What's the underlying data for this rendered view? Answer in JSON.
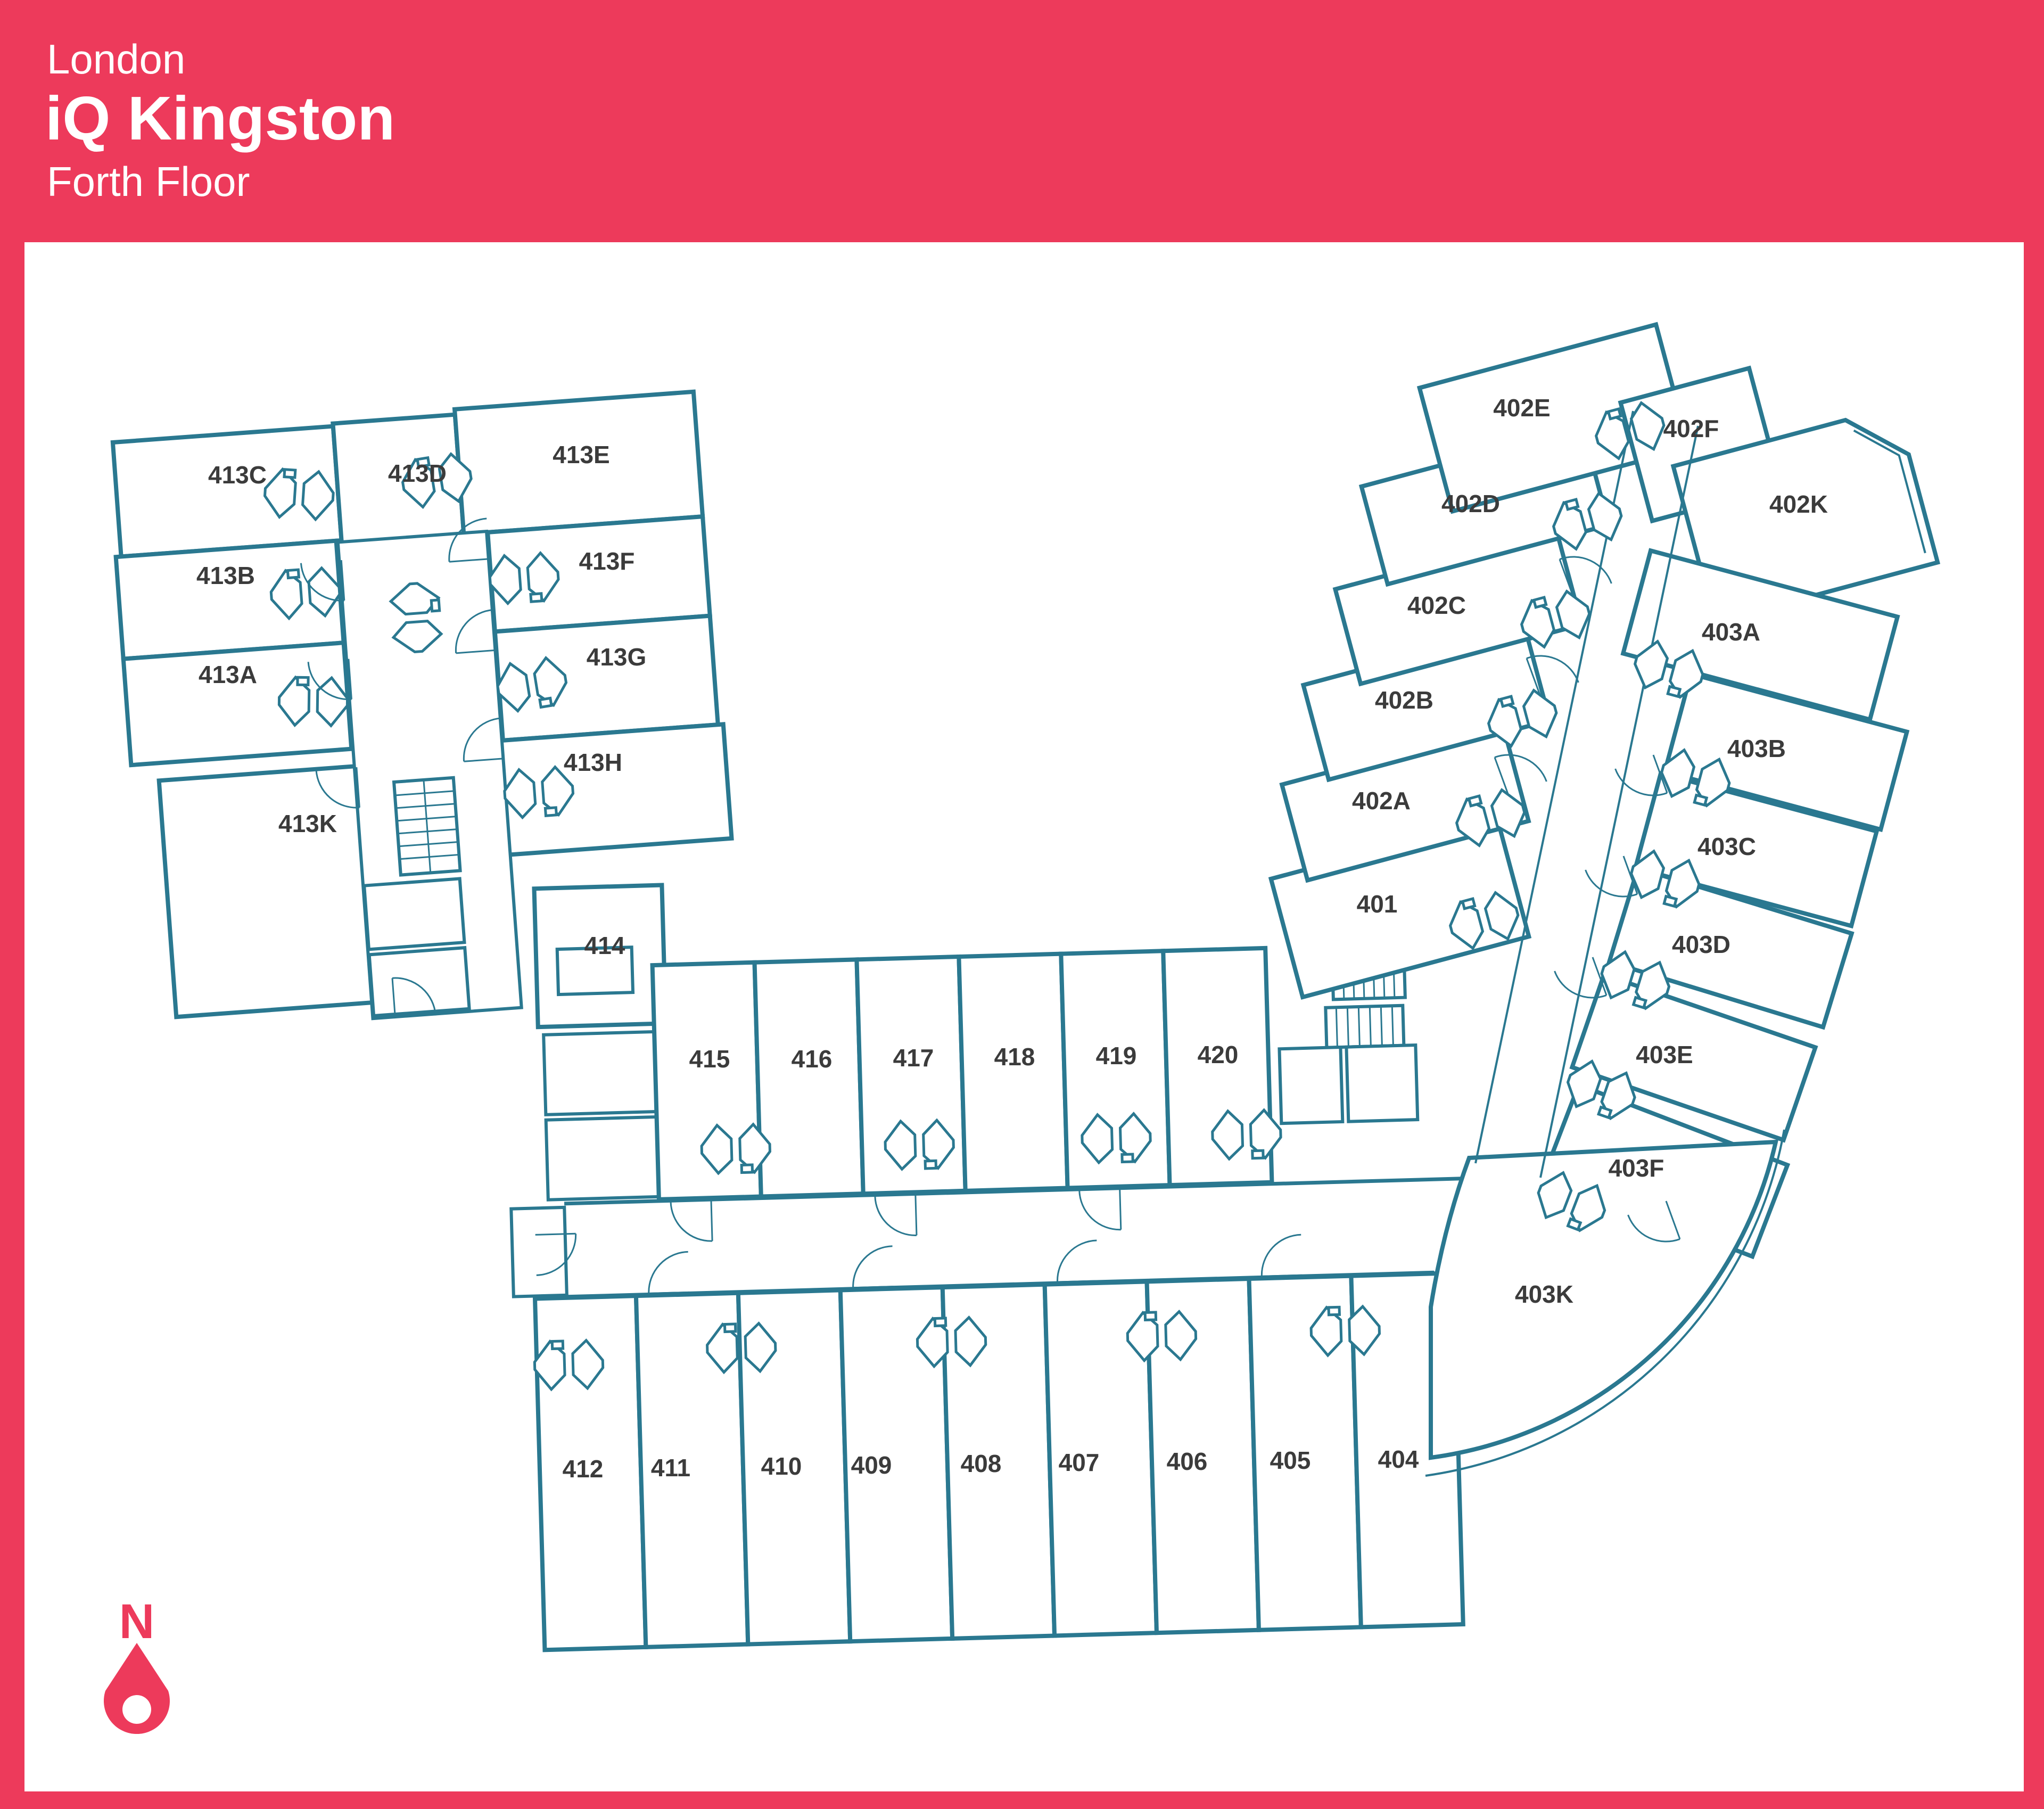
{
  "header": {
    "city": "London",
    "title": "iQ Kingston",
    "subtitle": "Forth Floor"
  },
  "compass": {
    "label": "N"
  },
  "colors": {
    "brand_red": "#ED3A5B",
    "wall_teal": "#2A7890",
    "label_dark": "#3B3B3B",
    "background": "#FFFFFF"
  },
  "floorplan": {
    "rooms": [
      {
        "id": "413C",
        "label": "413C"
      },
      {
        "id": "413D",
        "label": "413D"
      },
      {
        "id": "413E",
        "label": "413E"
      },
      {
        "id": "413B",
        "label": "413B"
      },
      {
        "id": "413F",
        "label": "413F"
      },
      {
        "id": "413A",
        "label": "413A"
      },
      {
        "id": "413G",
        "label": "413G"
      },
      {
        "id": "413H",
        "label": "413H"
      },
      {
        "id": "413K",
        "label": "413K"
      },
      {
        "id": "414",
        "label": "414"
      },
      {
        "id": "415",
        "label": "415"
      },
      {
        "id": "416",
        "label": "416"
      },
      {
        "id": "417",
        "label": "417"
      },
      {
        "id": "418",
        "label": "418"
      },
      {
        "id": "419",
        "label": "419"
      },
      {
        "id": "420",
        "label": "420"
      },
      {
        "id": "412",
        "label": "412"
      },
      {
        "id": "411",
        "label": "411"
      },
      {
        "id": "410",
        "label": "410"
      },
      {
        "id": "409",
        "label": "409"
      },
      {
        "id": "408",
        "label": "408"
      },
      {
        "id": "407",
        "label": "407"
      },
      {
        "id": "406",
        "label": "406"
      },
      {
        "id": "405",
        "label": "405"
      },
      {
        "id": "404",
        "label": "404"
      },
      {
        "id": "403K",
        "label": "403K"
      },
      {
        "id": "403F",
        "label": "403F"
      },
      {
        "id": "403E",
        "label": "403E"
      },
      {
        "id": "403D",
        "label": "403D"
      },
      {
        "id": "403C",
        "label": "403C"
      },
      {
        "id": "403B",
        "label": "403B"
      },
      {
        "id": "403A",
        "label": "403A"
      },
      {
        "id": "402K",
        "label": "402K"
      },
      {
        "id": "402F",
        "label": "402F"
      },
      {
        "id": "402E",
        "label": "402E"
      },
      {
        "id": "402D",
        "label": "402D"
      },
      {
        "id": "402C",
        "label": "402C"
      },
      {
        "id": "402B",
        "label": "402B"
      },
      {
        "id": "402A",
        "label": "402A"
      },
      {
        "id": "401",
        "label": "401"
      }
    ]
  }
}
